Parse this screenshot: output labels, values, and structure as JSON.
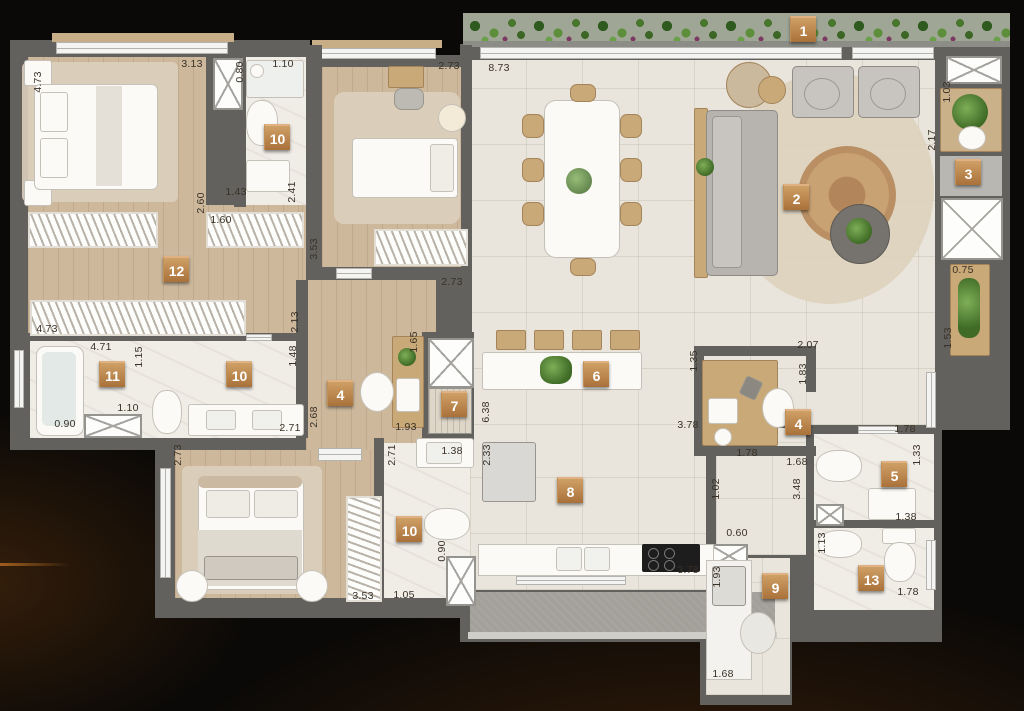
{
  "plan": {
    "tag_color": "#b9813f",
    "tags": [
      {
        "n": "1",
        "x": 790,
        "y": 16
      },
      {
        "n": "2",
        "x": 783,
        "y": 184
      },
      {
        "n": "3",
        "x": 955,
        "y": 159
      },
      {
        "n": "4",
        "x": 327,
        "y": 380
      },
      {
        "n": "4",
        "x": 785,
        "y": 409
      },
      {
        "n": "5",
        "x": 881,
        "y": 461
      },
      {
        "n": "6",
        "x": 583,
        "y": 361
      },
      {
        "n": "7",
        "x": 441,
        "y": 391
      },
      {
        "n": "8",
        "x": 557,
        "y": 477
      },
      {
        "n": "9",
        "x": 762,
        "y": 573
      },
      {
        "n": "10",
        "x": 264,
        "y": 124
      },
      {
        "n": "10",
        "x": 226,
        "y": 361
      },
      {
        "n": "10",
        "x": 396,
        "y": 516
      },
      {
        "n": "11",
        "x": 99,
        "y": 361
      },
      {
        "n": "12",
        "x": 163,
        "y": 256
      },
      {
        "n": "13",
        "x": 858,
        "y": 565
      }
    ],
    "dims": [
      {
        "t": "4.73",
        "x": 38,
        "y": 82,
        "v": true
      },
      {
        "t": "3.13",
        "x": 192,
        "y": 64,
        "v": false
      },
      {
        "t": "0.80",
        "x": 240,
        "y": 72,
        "v": true
      },
      {
        "t": "1.10",
        "x": 283,
        "y": 64,
        "v": false
      },
      {
        "t": "1.43",
        "x": 236,
        "y": 192,
        "v": false
      },
      {
        "t": "2.41",
        "x": 292,
        "y": 192,
        "v": true
      },
      {
        "t": "2.60",
        "x": 201,
        "y": 203,
        "v": true
      },
      {
        "t": "1.60",
        "x": 221,
        "y": 220,
        "v": false
      },
      {
        "t": "4.73",
        "x": 47,
        "y": 329,
        "v": false
      },
      {
        "t": "3.53",
        "x": 314,
        "y": 249,
        "v": true
      },
      {
        "t": "2.13",
        "x": 295,
        "y": 322,
        "v": true
      },
      {
        "t": "1.48",
        "x": 293,
        "y": 356,
        "v": true
      },
      {
        "t": "2.68",
        "x": 314,
        "y": 417,
        "v": true
      },
      {
        "t": "4.71",
        "x": 101,
        "y": 347,
        "v": false
      },
      {
        "t": "1.15",
        "x": 139,
        "y": 357,
        "v": true
      },
      {
        "t": "1.10",
        "x": 128,
        "y": 408,
        "v": false
      },
      {
        "t": "0.90",
        "x": 65,
        "y": 424,
        "v": false
      },
      {
        "t": "2.71",
        "x": 290,
        "y": 428,
        "v": false
      },
      {
        "t": "1.65",
        "x": 414,
        "y": 342,
        "v": true
      },
      {
        "t": "1.93",
        "x": 406,
        "y": 427,
        "v": false
      },
      {
        "t": "2.73",
        "x": 452,
        "y": 282,
        "v": false
      },
      {
        "t": "2.73",
        "x": 449,
        "y": 66,
        "v": false
      },
      {
        "t": "8.73",
        "x": 499,
        "y": 68,
        "v": false
      },
      {
        "t": "1.03",
        "x": 947,
        "y": 92,
        "v": true
      },
      {
        "t": "2.17",
        "x": 932,
        "y": 140,
        "v": true
      },
      {
        "t": "0.75",
        "x": 963,
        "y": 270,
        "v": false
      },
      {
        "t": "1.53",
        "x": 948,
        "y": 338,
        "v": true
      },
      {
        "t": "1.35",
        "x": 694,
        "y": 361,
        "v": true
      },
      {
        "t": "3.78",
        "x": 688,
        "y": 425,
        "v": false
      },
      {
        "t": "6.38",
        "x": 486,
        "y": 412,
        "v": true
      },
      {
        "t": "2.33",
        "x": 487,
        "y": 455,
        "v": true
      },
      {
        "t": "2.07",
        "x": 808,
        "y": 345,
        "v": false
      },
      {
        "t": "1.83",
        "x": 803,
        "y": 374,
        "v": true
      },
      {
        "t": "1.68",
        "x": 797,
        "y": 462,
        "v": false
      },
      {
        "t": "1.78",
        "x": 747,
        "y": 453,
        "v": false
      },
      {
        "t": "1.78",
        "x": 905,
        "y": 429,
        "v": false
      },
      {
        "t": "1.33",
        "x": 917,
        "y": 455,
        "v": true
      },
      {
        "t": "1.38",
        "x": 906,
        "y": 517,
        "v": false
      },
      {
        "t": "1.13",
        "x": 822,
        "y": 543,
        "v": true
      },
      {
        "t": "1.78",
        "x": 908,
        "y": 592,
        "v": false
      },
      {
        "t": "1.02",
        "x": 716,
        "y": 489,
        "v": true
      },
      {
        "t": "3.48",
        "x": 797,
        "y": 489,
        "v": true
      },
      {
        "t": "0.60",
        "x": 737,
        "y": 533,
        "v": false
      },
      {
        "t": "1.93",
        "x": 717,
        "y": 577,
        "v": true
      },
      {
        "t": "1.68",
        "x": 723,
        "y": 674,
        "v": false
      },
      {
        "t": "3.78",
        "x": 688,
        "y": 570,
        "v": false
      },
      {
        "t": "2.73",
        "x": 178,
        "y": 455,
        "v": true
      },
      {
        "t": "2.71",
        "x": 392,
        "y": 455,
        "v": true
      },
      {
        "t": "3.53",
        "x": 363,
        "y": 596,
        "v": false
      },
      {
        "t": "1.05",
        "x": 404,
        "y": 595,
        "v": false
      },
      {
        "t": "1.38",
        "x": 452,
        "y": 451,
        "v": false
      },
      {
        "t": "0.90",
        "x": 442,
        "y": 551,
        "v": true
      }
    ]
  }
}
